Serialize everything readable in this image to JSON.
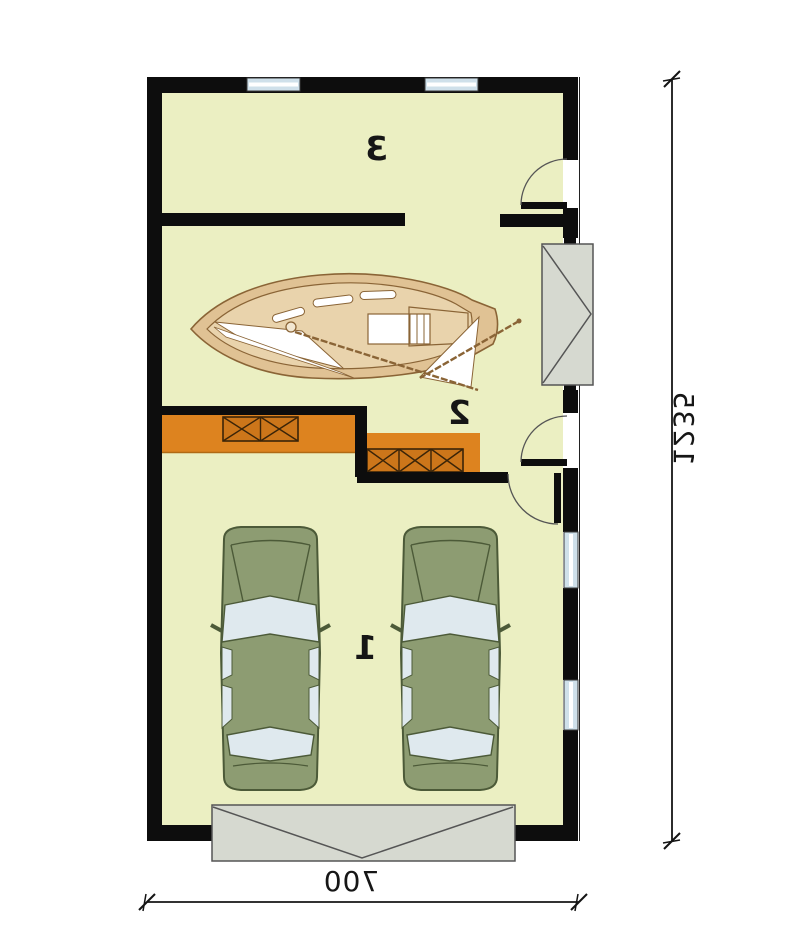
{
  "title": "Garage floor plan",
  "rooms": [
    {
      "number": "3"
    },
    {
      "number": "2"
    },
    {
      "number": "1"
    }
  ],
  "dimensions": {
    "width_label": "700",
    "height_label": "1235"
  },
  "objects": {
    "boat": "sailboat-top-view",
    "car_left": "car-top-view",
    "car_right": "car-top-view",
    "garage_door": "garage-door-panel",
    "boat_gate": "side-gate-panel",
    "stairs": "steps-with-crossed-boxes",
    "doors": [
      "swing-door-top-right",
      "swing-door-mid-right",
      "swing-door-interior"
    ],
    "windows": [
      "top-wall-window-1",
      "top-wall-window-2",
      "right-wall-window-1",
      "right-wall-window-2"
    ]
  },
  "colors": {
    "floor": "#ebefc2",
    "wall": "#0d0d0d",
    "orange": "#dd831f",
    "orange-dark": "#cc761a",
    "orange-line": "#3a2408",
    "car": "#8d9c72",
    "car-line": "#4c5a38",
    "car-window": "#dfe9ee",
    "boat-hull": "#e0c294",
    "boat-deck": "#e9d3ac",
    "boat-line": "#8a6436",
    "sail": "#ffffff",
    "panel": "#d6d9d0",
    "panel-line": "#555555",
    "glass": "#cfe0ea",
    "dim": "#141414",
    "label": "#161616"
  }
}
